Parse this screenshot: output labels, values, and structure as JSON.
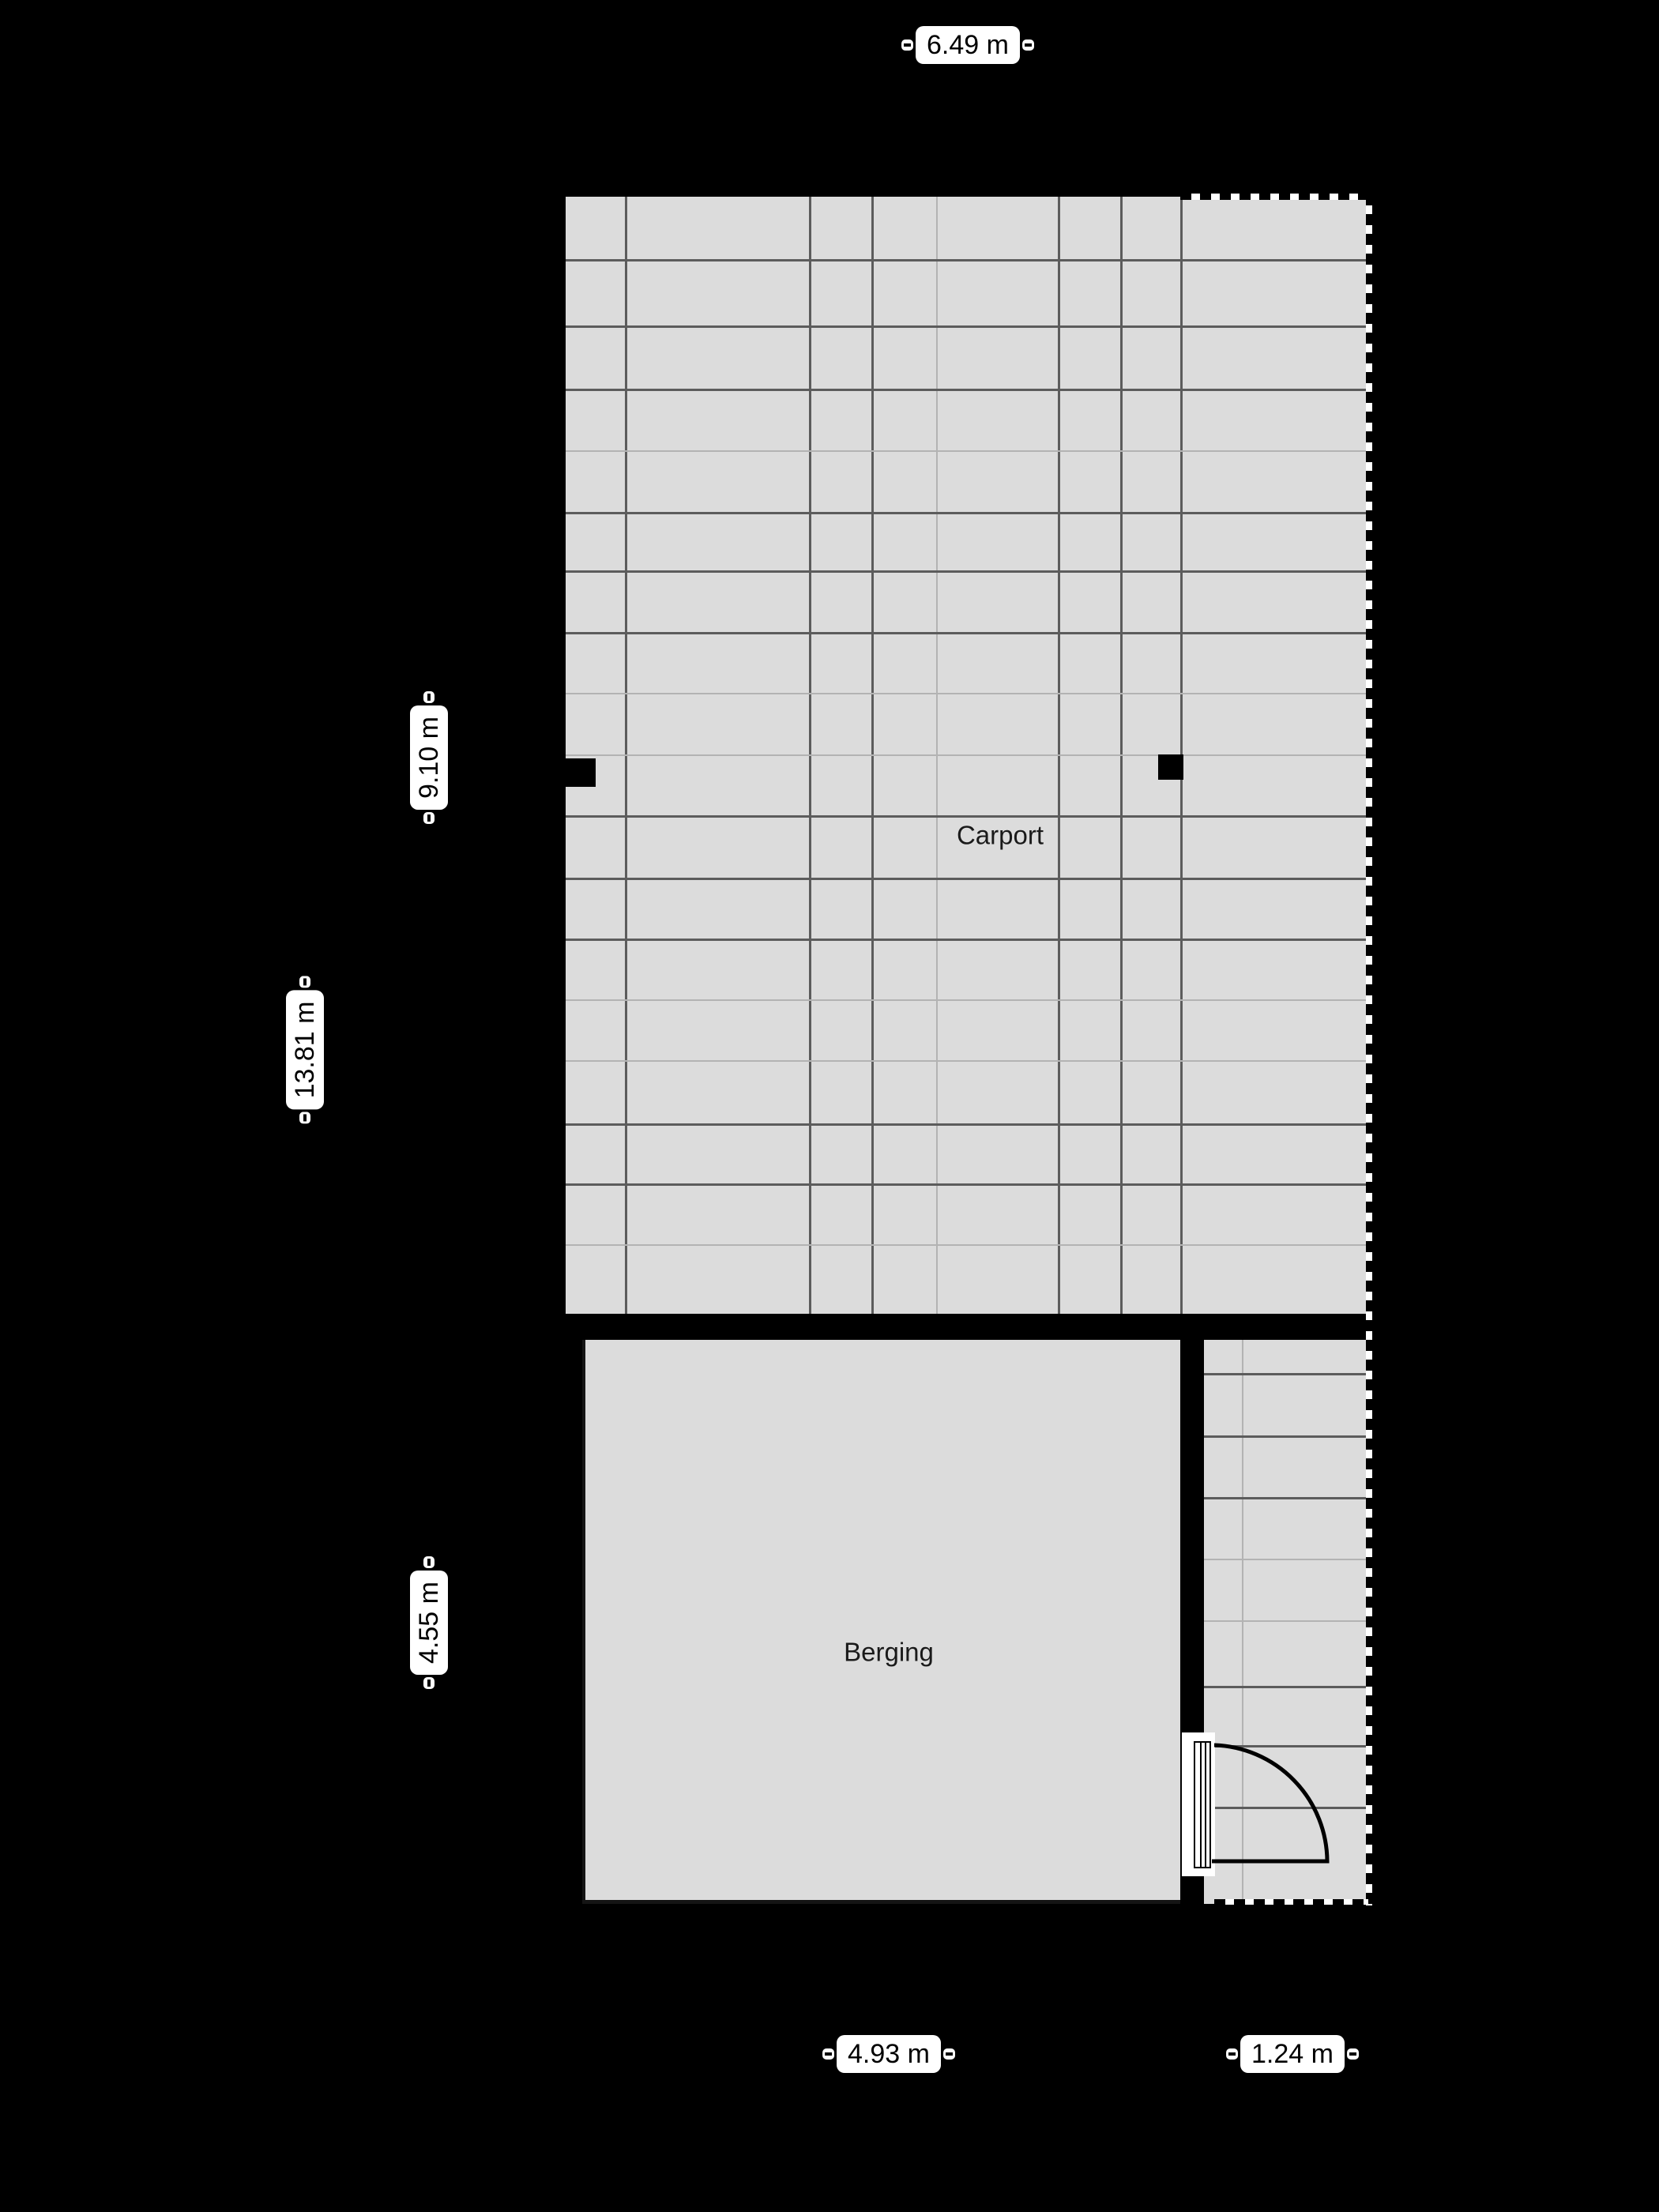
{
  "page": {
    "background": "#000000"
  },
  "floorplan": {
    "rooms": {
      "carport": {
        "label": "Carport"
      },
      "berging": {
        "label": "Berging"
      }
    },
    "dimensions": {
      "width_total": "6.49 m",
      "height_carport": "9.10 m",
      "height_total": "13.81 m",
      "height_berging": "4.55 m",
      "width_berging": "4.93 m",
      "width_strip": "1.24 m"
    },
    "colors": {
      "background": "#000000",
      "floor": "#dcdcdc",
      "wall": "#000000",
      "grid_dark": "#5c5c5c",
      "grid_faint": "#b3b3b3",
      "label_bg": "#ffffff",
      "label_text": "#000000"
    },
    "grid": {
      "carport": {
        "area": [
          716,
          249,
          1732,
          1663
        ],
        "v_dark": [
          791,
          1024,
          1103,
          1339,
          1418,
          1494
        ],
        "v_faint": [
          1185
        ],
        "h_dark": [
          328,
          412,
          492,
          648,
          722,
          800,
          1032,
          1111,
          1188,
          1422,
          1498
        ],
        "h_faint": [
          570,
          877,
          955,
          1265,
          1342,
          1575
        ]
      },
      "strip": {
        "area": [
          1524,
          1696,
          1732,
          2410
        ],
        "v_dark": [],
        "v_faint": [
          1572
        ],
        "h_dark": [
          1738,
          1817,
          1895,
          2134,
          2209,
          2287
        ],
        "h_faint": [
          1973,
          2051
        ]
      }
    }
  }
}
